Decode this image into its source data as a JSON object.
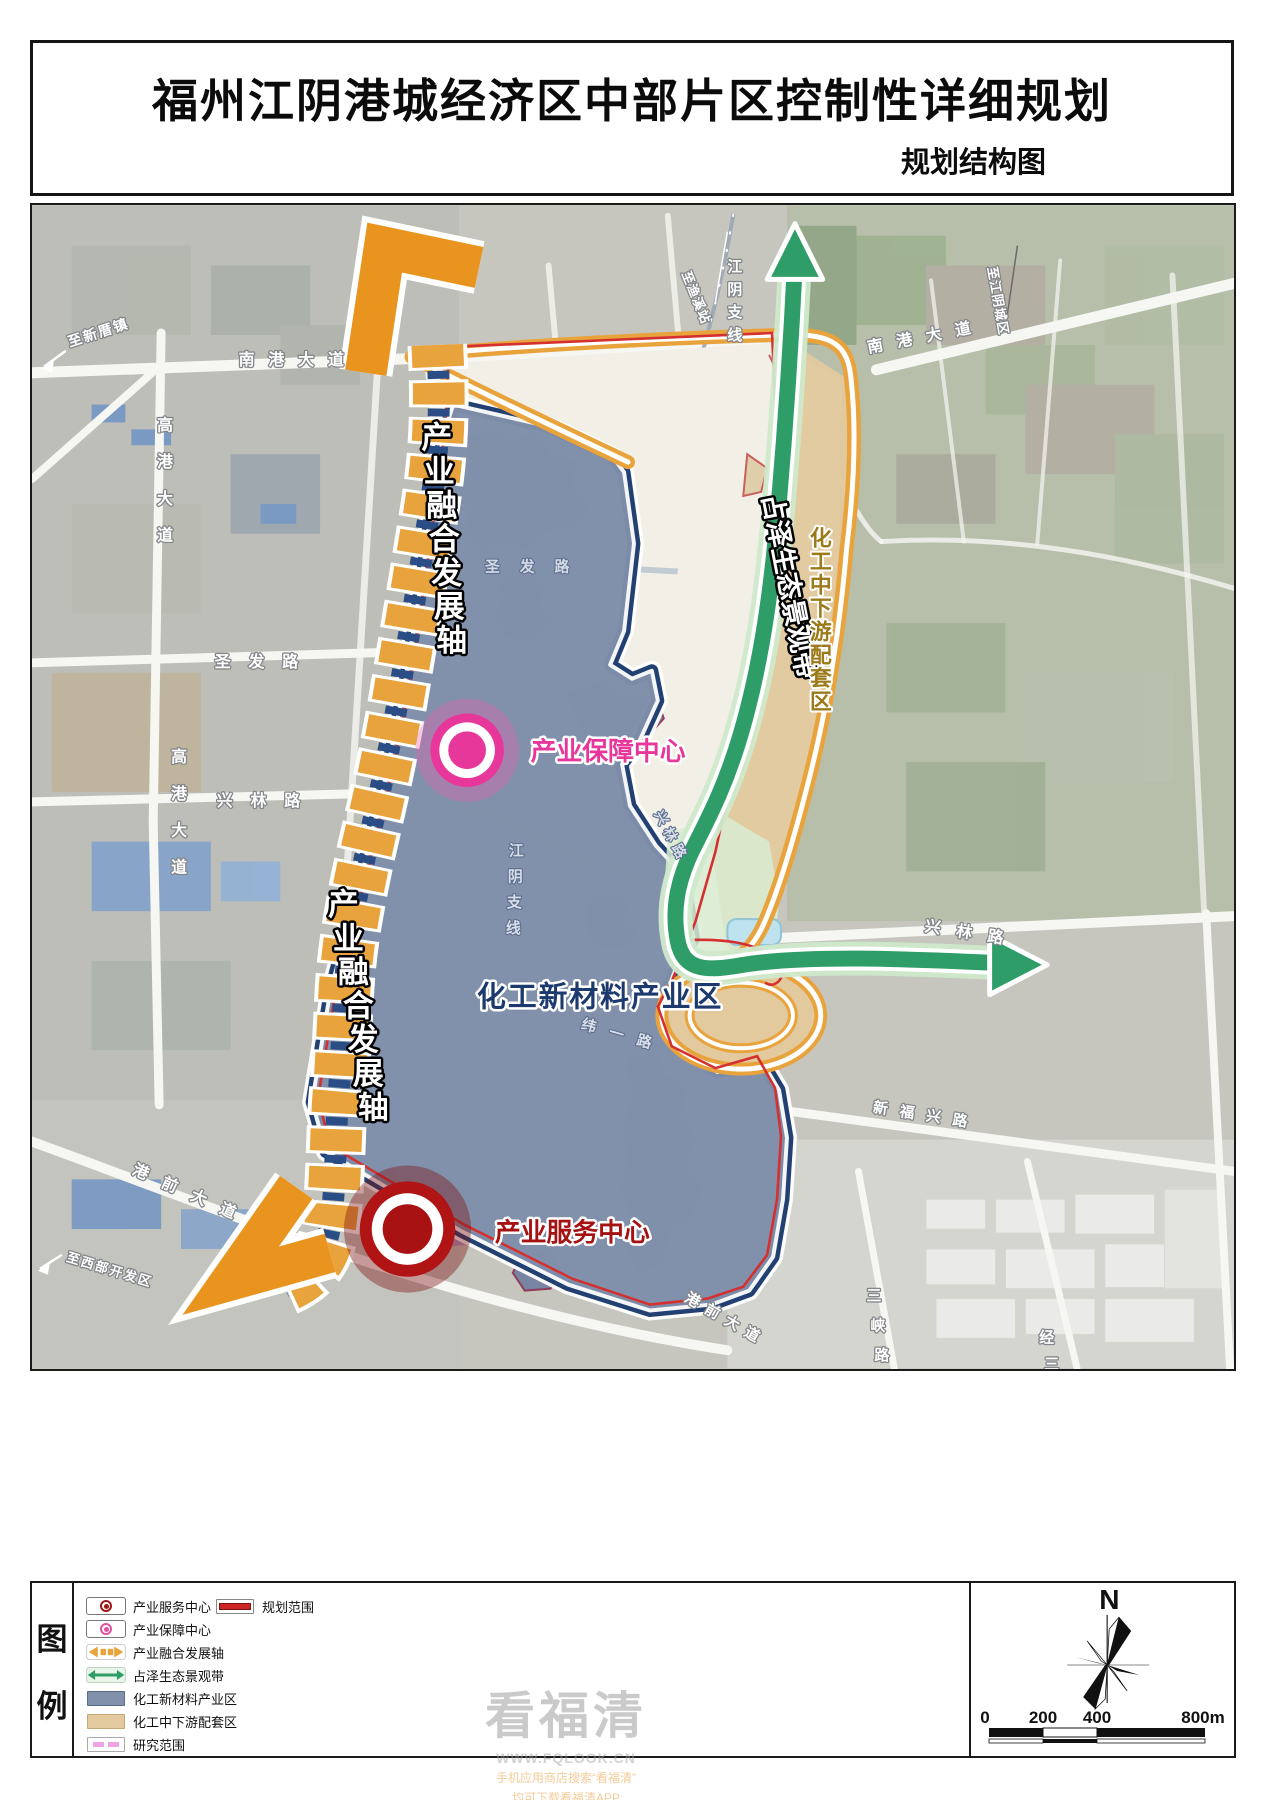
{
  "title": {
    "main": "福州江阴港城经济区中部片区控制性详细规划",
    "sub": "规划结构图"
  },
  "map": {
    "axis_label_1": "产业融合发展轴",
    "axis_label_2": "产业融合发展轴",
    "belt_label": "占泽生态景观带",
    "zone_blue_label": "化工新材料产业区",
    "zone_tan_label": "化工中下游配套区",
    "center_support_label": "产业保障中心",
    "center_service_label": "产业服务中心",
    "roads": {
      "nangang_w": "南港大道",
      "nangang_e": "南港大道",
      "gaogang_n": "高港大道",
      "gaogang_s": "高港大道",
      "shengfa": "圣发路",
      "shengfa_inner": "圣发路",
      "xinglin_w": "兴林路",
      "xinglin_inner": "兴林路",
      "xinglin_e": "兴林路",
      "rail_n": "江阴支线",
      "rail_s": "江阴支线",
      "weiyi": "纬一路",
      "xinfuxing": "新福兴路",
      "gangqian_w": "港前大道",
      "gangqian_s": "港前大道",
      "sanxia": "三峡路",
      "jingsan": "经三路"
    },
    "destinations": {
      "xincuo": "至新厝镇",
      "yuxi": "至渔溪站",
      "city": "至江阴城区",
      "xibu": "至西部开发区"
    }
  },
  "legend": {
    "heading_top": "图",
    "heading_bottom": "例",
    "items": [
      {
        "label": "产业服务中心"
      },
      {
        "label": "产业保障中心"
      },
      {
        "label": "产业融合发展轴"
      },
      {
        "label": "占泽生态景观带"
      },
      {
        "label": "化工新材料产业区"
      },
      {
        "label": "化工中下游配套区"
      },
      {
        "label": "研究范围"
      },
      {
        "label": "规划范围"
      }
    ]
  },
  "compass_label": "N",
  "scale": {
    "t0": "0",
    "t1": "200",
    "t2": "400",
    "t3": "800m"
  },
  "watermark": {
    "brand": "看福清",
    "site": "WWW.FQLOOK.CN",
    "line1": "手机应用商店搜索“看福清”",
    "line2": "均可下载看福清APP"
  },
  "colors": {
    "axis_orange": "#e9a33c",
    "belt_green": "#2f9d68",
    "zone_blue": "#8191ab",
    "zone_tan": "#e2c99e",
    "band_navy": "#17376b",
    "boundary_red": "#cc2626",
    "research_pink": "#efa2e4",
    "center_service_red": "#a81212",
    "center_support_pink": "#e8379a"
  }
}
